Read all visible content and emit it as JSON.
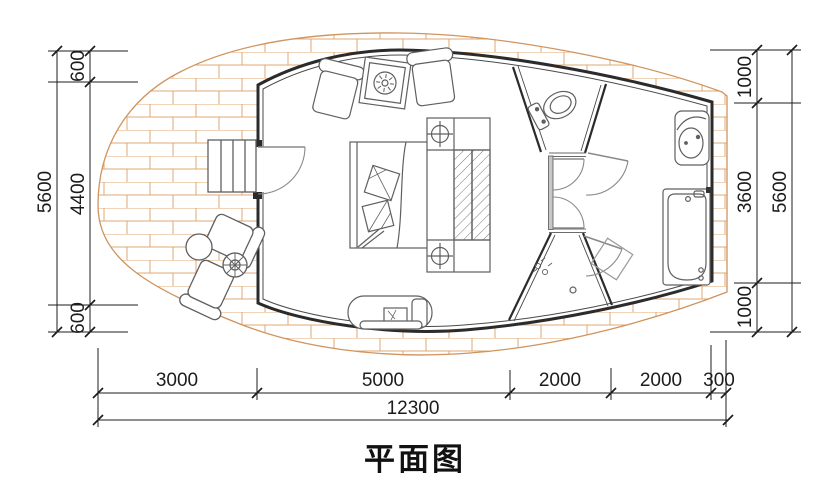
{
  "title": "平面图",
  "drawing_type": "floor-plan",
  "dimensions": {
    "left": {
      "total": "5600",
      "segments": [
        "600",
        "4400",
        "600"
      ]
    },
    "right": {
      "total": "5600",
      "segments": [
        "1000",
        "3600",
        "1000"
      ]
    },
    "bottom": {
      "total": "12300",
      "segments": [
        "3000",
        "5000",
        "2000",
        "2000",
        "300"
      ]
    }
  },
  "fixtures": [
    "deck-brick-paving",
    "entry-stairs",
    "entrance-door",
    "lounge-chair",
    "side-table",
    "double-bed",
    "pillow",
    "table-lamp",
    "nightstand",
    "wardrobe",
    "bench",
    "outdoor-chair",
    "round-table",
    "plant-pot",
    "toilet",
    "shower-drain",
    "shower-head",
    "washbasin",
    "bathtub",
    "door-swing"
  ],
  "colors": {
    "wall": "#2b2b2b",
    "inner_wall_line": "#4a4a4a",
    "brick_joint": "#e2a873",
    "deck_edge": "#d0945e",
    "furniture_line": "#5f5f5f",
    "door_line": "#8a8a8a",
    "dimension_line": "#1c1c1c"
  }
}
